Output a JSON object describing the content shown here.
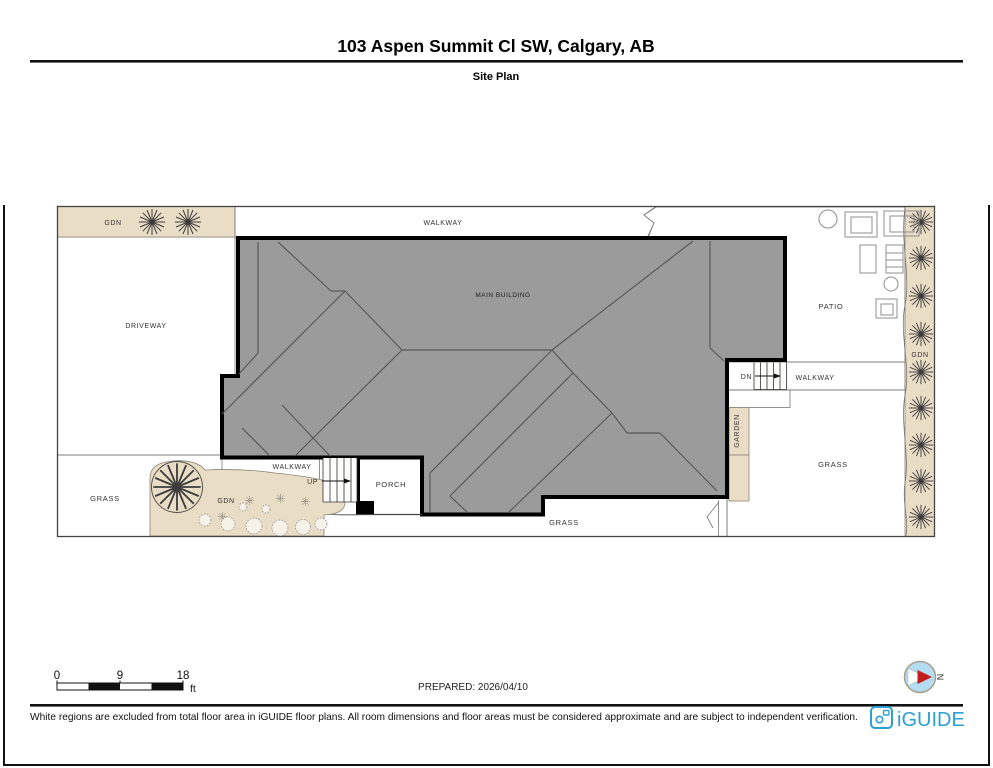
{
  "header": {
    "title": "103 Aspen Summit Cl SW, Calgary, AB",
    "subtitle": "Site Plan"
  },
  "plan": {
    "labels": {
      "gdn_top": "GDN",
      "driveway": "DRIVEWAY",
      "walkway_top": "WALKWAY",
      "main_building": "MAIN BUILDING",
      "patio": "PATIO",
      "gdn_right": "GDN",
      "dn": "DN",
      "walkway_right": "WALKWAY",
      "garden": "GARDEN",
      "grass_right": "GRASS",
      "grass_left": "GRASS",
      "grass_bottom": "GRASS",
      "gdn_bottom": "GDN",
      "walkway_bottom": "WALKWAY",
      "up": "UP",
      "porch": "PORCH"
    }
  },
  "scalebar": {
    "tick0": "0",
    "tick1": "9",
    "tick2": "18",
    "unit": "ft"
  },
  "prepared_label": "PREPARED: 2026/04/10",
  "compass": {
    "north": "N"
  },
  "footer": {
    "disclaimer": "White regions are excluded from total floor area in iGUIDE floor plans. All room dimensions and floor areas must be considered approximate and are subject to independent verification.",
    "brand": "iGUIDE"
  },
  "colors": {
    "building": "#9b9b9b",
    "beige": "#eaddc6",
    "grass_bg": "#e7efe8",
    "hatch_bg": "#eceae6",
    "brand_blue": "#2d9fd4",
    "compass_fill": "#b4ddf2",
    "compass_red": "#c41d1d"
  }
}
